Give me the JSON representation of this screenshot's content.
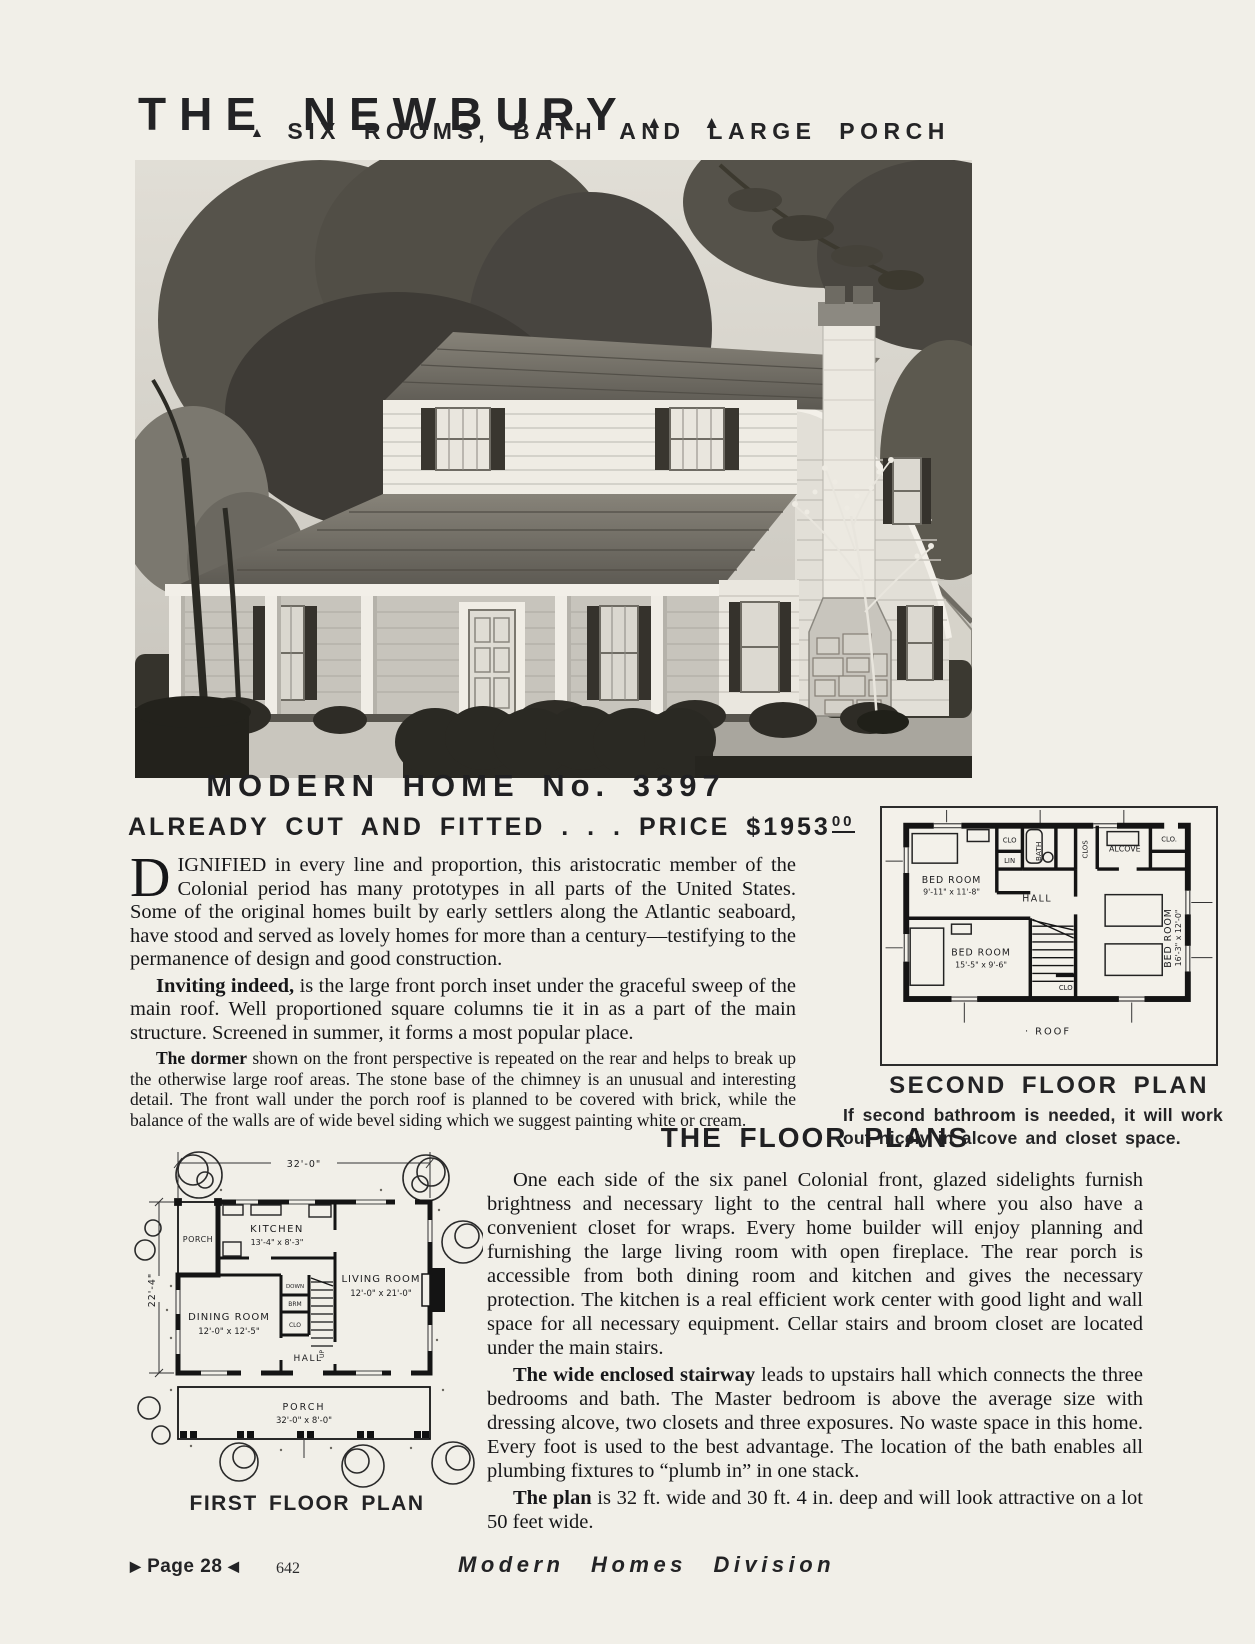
{
  "page": {
    "title": "THE NEWBURY",
    "title_marks": "▲ ▲",
    "subtitle_mark": "▲",
    "subtitle": "SIX ROOMS, BATH AND LARGE PORCH",
    "footer": {
      "page_marker_left": "▶",
      "page_label": "Page 28",
      "page_marker_right": "◀",
      "catalog_number": "642",
      "division": "Modern Homes Division"
    }
  },
  "listing": {
    "heading": "MODERN HOME No. 3397",
    "price_line": "ALREADY CUT AND FITTED . . . PRICE $1953",
    "price_cents": "00",
    "dropcap": "D",
    "para1_rest": "IGNIFIED in every line and proportion, this aristocratic member of the Colonial period has many prototypes in all parts of the United States. Some of the original homes built by early settlers along the Atlantic seaboard, have stood and served as lovely homes for more than a century—testifying to the permanence of design and good construction.",
    "para2_lead": "Inviting indeed,",
    "para2_rest": " is the large front porch inset under the graceful sweep of the main roof. Well proportioned square columns tie it in as a part of the main structure. Screened in summer, it forms a most popular place.",
    "para3_lead": "The dormer",
    "para3_rest": " shown on the front perspective is repeated on the rear and helps to break up the otherwise large roof areas. The stone base of the chimney is an unusual and interesting detail. The front wall under the porch roof is planned to be covered with brick, while the balance of the walls are of wide bevel siding which we suggest painting white or cream."
  },
  "second_floor_plan": {
    "caption": "SECOND FLOOR PLAN",
    "note": "If second bathroom is needed, it will work out nicely in alcove and closet space.",
    "labels": {
      "bedroom1": "BED ROOM",
      "bedroom1_dims": "9'-11\" x 11'-8\"",
      "bedroom2": "BED ROOM",
      "bedroom2_dims": "15'-5\" x 9'-6\"",
      "bedroom3": "BED ROOM",
      "bedroom3_dims": "16'-3\" x 12'-0\"",
      "hall": "HALL",
      "bath": "BATH",
      "lin": "LIN",
      "clo_left": "CLO",
      "clos": "CLOS",
      "alcove": "ALCOVE",
      "clo_right": "CLO.",
      "clo_bottom": "CLO",
      "roof": "· ROOF"
    }
  },
  "first_floor_plan": {
    "caption": "FIRST FLOOR PLAN",
    "labels": {
      "width_dim": "32'-0\"",
      "depth_dim": "22'-4\"",
      "porch_rear": "PORCH",
      "kitchen": "KITCHEN",
      "kitchen_dims": "13'-4\" x 8'-3\"",
      "living": "LIVING ROOM",
      "living_dims": "12'-0\" x 21'-0\"",
      "dining": "DINING ROOM",
      "dining_dims": "12'-0\" x 12'-5\"",
      "hall": "HALL",
      "down": "DOWN",
      "brm": "BRM",
      "clo": "CLO",
      "up": "UP",
      "porch_front": "PORCH",
      "porch_front_dims": "32'-0\" x 8'-0\""
    }
  },
  "floor_plans_article": {
    "heading": "THE FLOOR PLANS",
    "para1": "One each side of the six panel Colonial front, glazed sidelights furnish brightness and necessary light to the central hall where you also have a convenient closet for wraps. Every home builder will enjoy planning and furnishing the large living room with open fireplace. The rear porch is accessible from both dining room and kitchen and gives the necessary protection. The kitchen is a real efficient work center with good light and wall space for all necessary equipment. Cellar stairs and broom closet are located under the main stairs.",
    "para2_lead": "The wide enclosed stairway",
    "para2_rest": " leads to upstairs hall which connects the three bedrooms and bath. The Master bedroom is above the average size with dressing alcove, two closets and three exposures. No waste space in this home. Every foot is used to the best advantage. The location of the bath enables all plumbing fixtures to “plumb in” in one stack.",
    "para3_lead": "The plan",
    "para3_rest": " is 32 ft. wide and 30 ft. 4 in. deep and will look attractive on a lot 50 feet wide."
  }
}
